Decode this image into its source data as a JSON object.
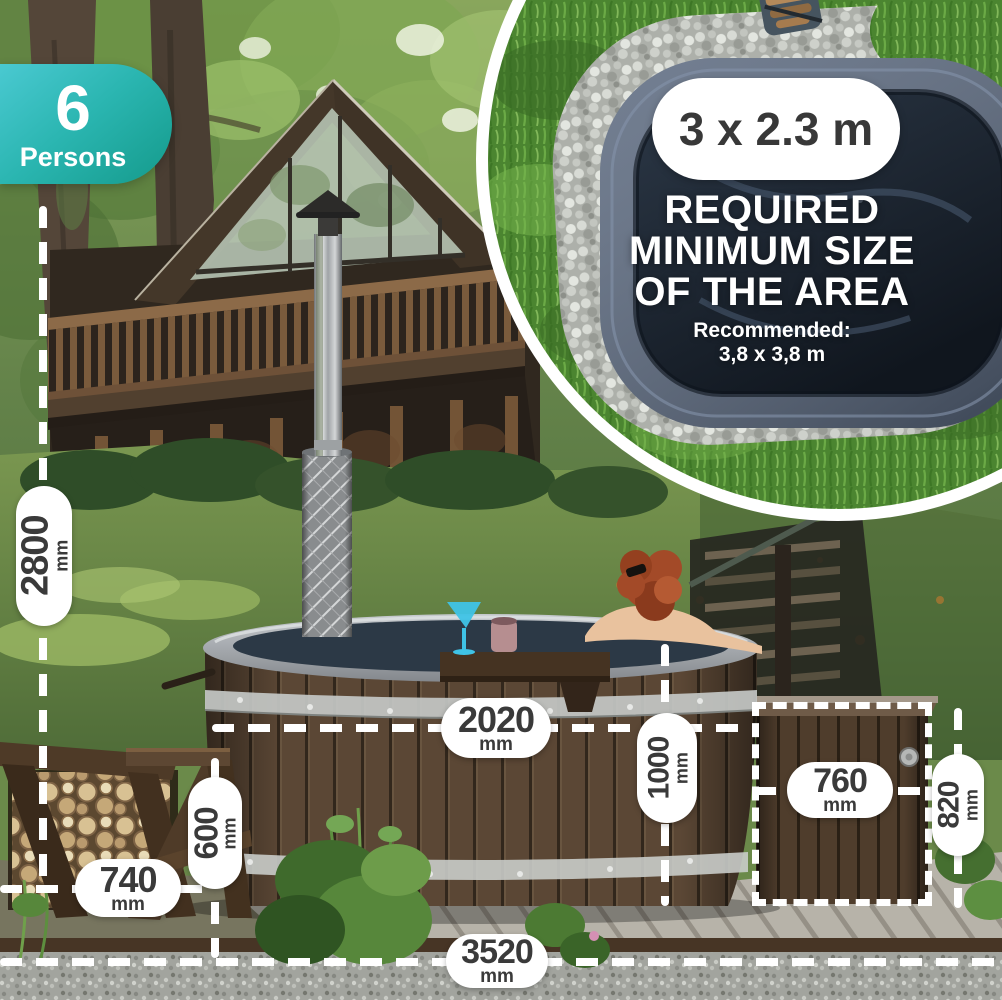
{
  "badge": {
    "count": "6",
    "label": "Persons"
  },
  "inset": {
    "size": "3 x 2.3 m",
    "heading_line1": "REQUIRED",
    "heading_line2": "MINIMUM SIZE",
    "heading_line3": "OF THE AREA",
    "recommended_label": "Recommended:",
    "recommended_size": "3,8 x 3,8 m"
  },
  "dimensions": {
    "overall_height": {
      "value": "2800",
      "unit": "mm"
    },
    "woodshed_width": {
      "value": "740",
      "unit": "mm"
    },
    "step_height": {
      "value": "600",
      "unit": "mm"
    },
    "tub_diameter": {
      "value": "2020",
      "unit": "mm"
    },
    "tub_height": {
      "value": "1000",
      "unit": "mm"
    },
    "heater_box_width": {
      "value": "760",
      "unit": "mm"
    },
    "heater_box_height": {
      "value": "820",
      "unit": "mm"
    },
    "total_length": {
      "value": "3520",
      "unit": "mm"
    }
  },
  "colors": {
    "badge_gradient_start": "#4ac9d1",
    "badge_gradient_end": "#149a8b",
    "annotation": "#ffffff",
    "pill_text": "#3a3a3a",
    "inset_tub_rim": "#5c6a80"
  }
}
